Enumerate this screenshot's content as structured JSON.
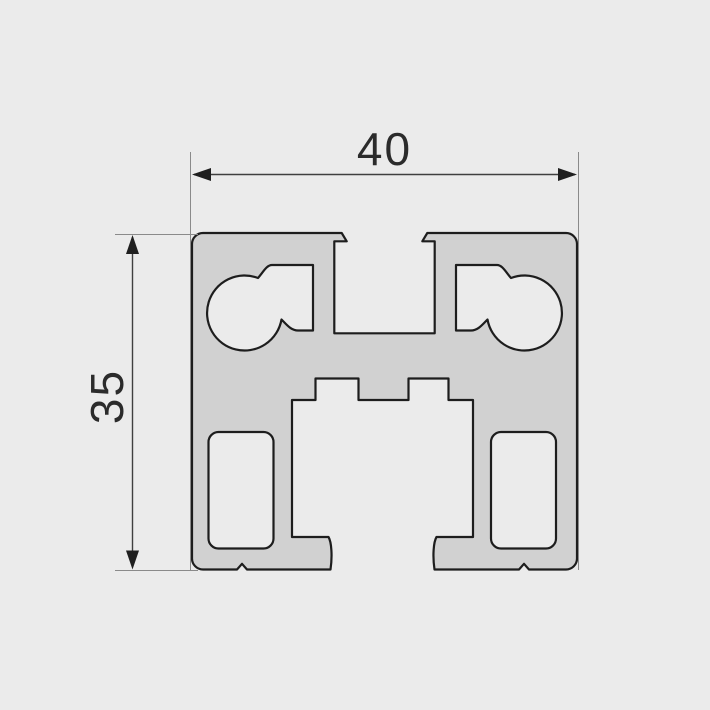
{
  "drawing": {
    "kind": "extrusion-profile-cross-section",
    "dimensions": {
      "width": {
        "label": "40",
        "orientation": "horizontal"
      },
      "height": {
        "label": "35",
        "orientation": "vertical"
      }
    },
    "colors": {
      "background": "#EBEBEB",
      "profile_fill": "#D1D1D1",
      "outline": "#1D1D1D",
      "dimension_line": "#3F3F3F",
      "extension_line": "#8A8A8A",
      "arrow": "#1F1F1F",
      "text": "#2B2B2B"
    }
  }
}
